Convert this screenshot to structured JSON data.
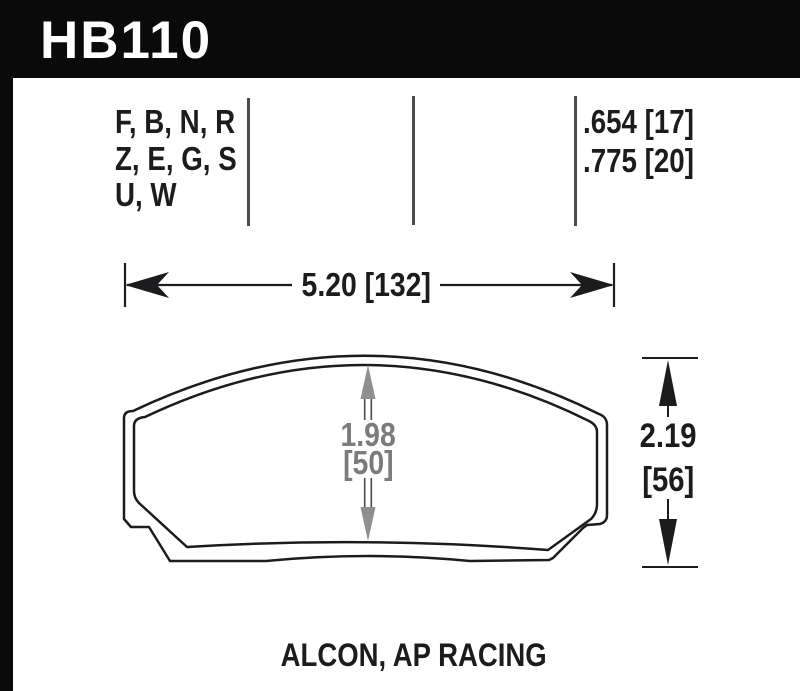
{
  "header": {
    "part_number": "HB110"
  },
  "spec": {
    "compound_lines": [
      "F, B, N, R",
      "Z, E, G, S",
      "U, W"
    ],
    "thickness_lines": [
      ".654 [17]",
      ".775 [20]"
    ]
  },
  "dimensions": {
    "width_label": "5.20 [132]",
    "pad_height_in": "1.98",
    "pad_height_mm": "[50]",
    "overall_height_in": "2.19",
    "overall_height_mm": "[56]"
  },
  "footer": {
    "applications": "ALCON, AP RACING"
  },
  "colors": {
    "header_bg": "#0a0a0a",
    "header_text": "#ffffff",
    "line_black": "#1c1c1e",
    "dim_gray_text": "#7b7b7e",
    "dim_gray_arrow": "#8f8f91"
  }
}
